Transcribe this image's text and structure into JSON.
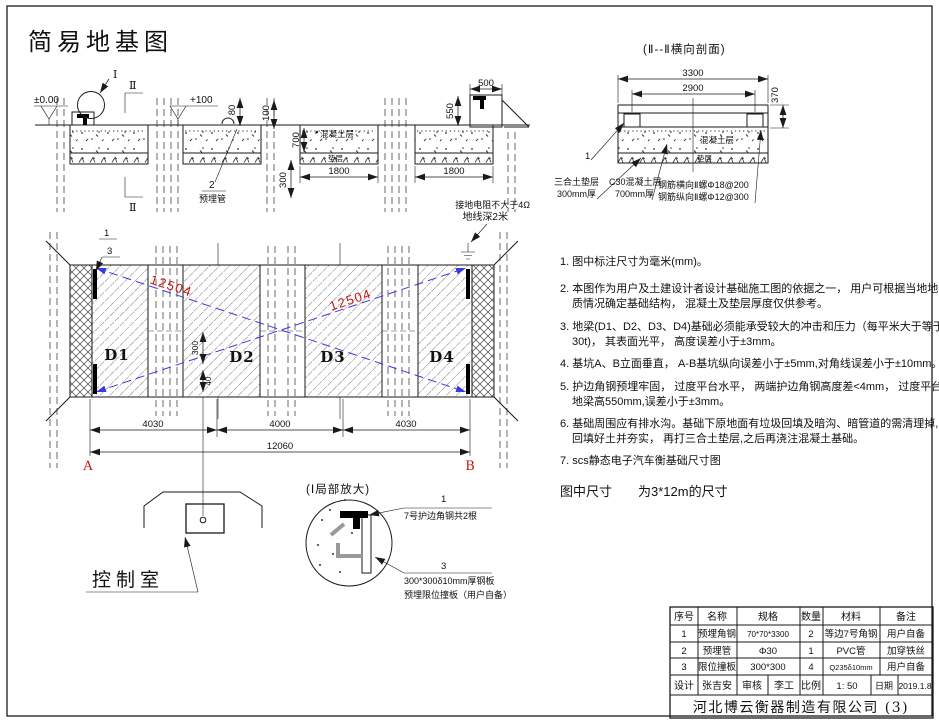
{
  "title": "简易地基图",
  "colors": {
    "red": "#c41414",
    "blue": "#3a3ae0",
    "line": "#1a1a1a"
  },
  "section_left": {
    "detail_mark": "Ⅰ",
    "section_mark": "Ⅱ",
    "elev_zero": "±0.00",
    "elev_plus": "+100",
    "dim_80": "80",
    "dim_100": "100",
    "dim_700": "700",
    "dim_300": "300",
    "dim_1800": "1800",
    "dim_500": "500",
    "dim_550": "550",
    "concrete_label": "混凝土层",
    "cushion_label": "垫层",
    "callout_2": "2",
    "callout_2_label": "预埋管"
  },
  "section_right": {
    "title": "(Ⅱ--Ⅱ横向剖面)",
    "dim_3300": "3300",
    "dim_2900": "2900",
    "dim_370": "370",
    "concrete_label": "混凝土层",
    "cushion_label": "垫层",
    "callout_1": "1",
    "pad_label_1": "三合土垫层",
    "pad_label_2": "300mm厚",
    "c30_label_1": "C30混凝土层",
    "c30_label_2": "700mm厚",
    "rebar_label_1": "钢筋横向Ⅱ螺Φ18@200",
    "rebar_label_2": "钢筋纵向Ⅱ螺Φ12@300"
  },
  "plan": {
    "blocks": [
      "D1",
      "D2",
      "D3",
      "D4"
    ],
    "callout_1": "1",
    "callout_3": "3",
    "ground_line_1": "接地电阻不大于4Ω",
    "ground_line_2": "地线深2米",
    "diag_dim": "12504",
    "dim_seg_1": "4030",
    "dim_seg_2": "4000",
    "dim_seg_3": "4030",
    "dim_total": "12060",
    "dim_v300": "300",
    "dim_v40": "40",
    "corner_a": "A",
    "corner_b": "B"
  },
  "control_room": {
    "label": "控制室"
  },
  "detail": {
    "title": "(Ⅰ局部放大)",
    "callout_1": "1",
    "callout_1_label": "7号护边角钢共2根",
    "callout_3": "3",
    "callout_3_label_1": "300*300δ10mm厚钢板",
    "callout_3_label_2": "预埋限位撞板（用户自备）"
  },
  "notes": [
    [
      "1. 图中标注尺寸为毫米(mm)。"
    ],
    [
      "2. 本图作为用户及土建设计者设计基础施工图的依据之一， 用户可根据当地地",
      "质情况确定基础结构， 混凝土及垫层厚度仅供参考。"
    ],
    [
      "3. 地梁(D1、D2、D3、D4)基础必须能承受较大的冲击和压力（每平米大于等于",
      "30t)， 其表面光平， 高度误差小于±3mm。"
    ],
    [
      "4. 基坑A、B立面垂直， A-B基坑纵向误差小于±5mm,对角线误差小于±10mm。"
    ],
    [
      "5. 护边角钢预埋牢固， 过度平台水平， 两端护边角钢高度差<4mm， 过度平台比",
      "地梁高550mm,误差小于±3mm。"
    ],
    [
      "6. 基础周围应有排水沟。基础下原地面有垃圾回填及暗沟、暗管道的需清理掉,",
      "回填好土并夯实， 再打三合土垫层,之后再浇注混凝土基础。"
    ],
    [
      "7. scs静态电子汽车衡基础尺寸图"
    ]
  ],
  "size_note": "图中尺寸　　为3*12m的尺寸",
  "table": {
    "headers": [
      "序号",
      "名称",
      "规格",
      "数量",
      "材料",
      "备注"
    ],
    "rows": [
      [
        "1",
        "预埋角钢",
        "70*70*3300",
        "2",
        "等边7号角钢",
        "用户自备"
      ],
      [
        "2",
        "预埋管",
        "Φ30",
        "1",
        "PVC管",
        "加穿铁丝"
      ],
      [
        "3",
        "限位撞板",
        "300*300",
        "4",
        "Q235δ10mm",
        "用户自备"
      ]
    ],
    "footer": {
      "design_label": "设计",
      "designer": "张吉安",
      "review_label": "审核",
      "reviewer": "李工",
      "scale_label": "比例",
      "scale": "1: 50",
      "date_label": "日期",
      "date": "2019.1.8"
    },
    "company": "河北博云衡器制造有限公司 (3)"
  }
}
